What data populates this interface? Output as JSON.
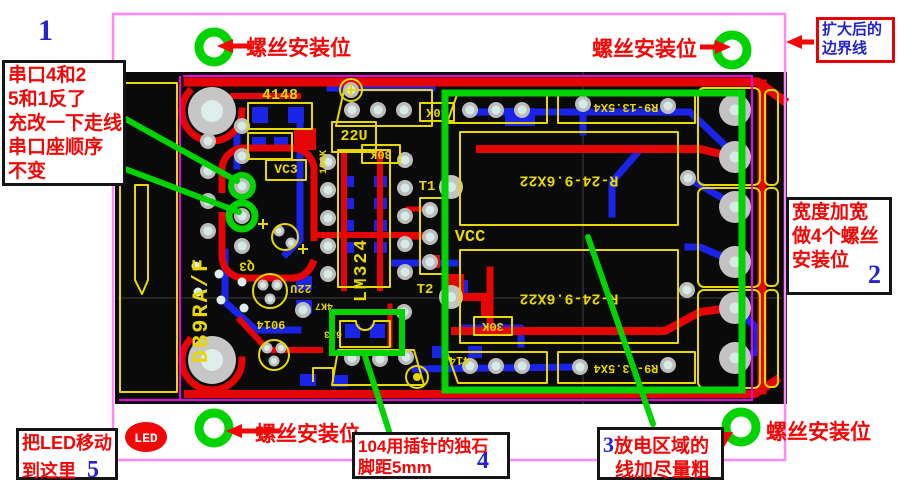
{
  "annotations": {
    "numbers": {
      "n1": "1",
      "n2": "2",
      "n3": "3",
      "n4": "4",
      "n5": "5"
    },
    "screw_label": "螺丝安装位",
    "serial_box": {
      "lines": [
        "串口4和2",
        "5和1反了",
        "充改一下走线",
        "串口座顺序",
        "不变"
      ]
    },
    "boundary_box": {
      "lines": [
        "扩大后的",
        "边界线"
      ]
    },
    "width_box": {
      "lines": [
        "宽度加宽",
        "做4个螺丝",
        "安装位"
      ]
    },
    "led_box": {
      "lines": [
        "把LED移动",
        "到这里"
      ]
    },
    "cap_box": {
      "lines": [
        "104用插针的独石",
        "脚距5mm"
      ]
    },
    "discharge_box": {
      "lines": [
        "放电区域的",
        "线加尽量粗"
      ]
    },
    "led_marker": "LED"
  },
  "pcb": {
    "labels": {
      "connector": "DB9RA/F",
      "diode_4148": "4148",
      "cap_22u": "22U",
      "res_100k": "100K",
      "vc3": "VC3",
      "opamp": "LM324",
      "t1": "T1",
      "t2": "T2",
      "vcc": "VCC",
      "relay": "R-24-9.6X22",
      "relay_pins": "R9-13.5X4",
      "res_30k": "30K",
      "q3": "Q3",
      "transistor": "9014",
      "res_4k7": "4K7",
      "x63": "6X3"
    }
  },
  "colors": {
    "annotation_red": "#f20606",
    "marker_green": "#00d300",
    "boundary_pink": "#ff86ff",
    "inner_boundary_magenta": "#ea00ea",
    "number_blue": "#2424cf",
    "silkscreen_yellow": "#e8d700",
    "trace_red": "#e60505",
    "trace_blue": "#1a23e8",
    "board_black": "#0a0a0a"
  }
}
